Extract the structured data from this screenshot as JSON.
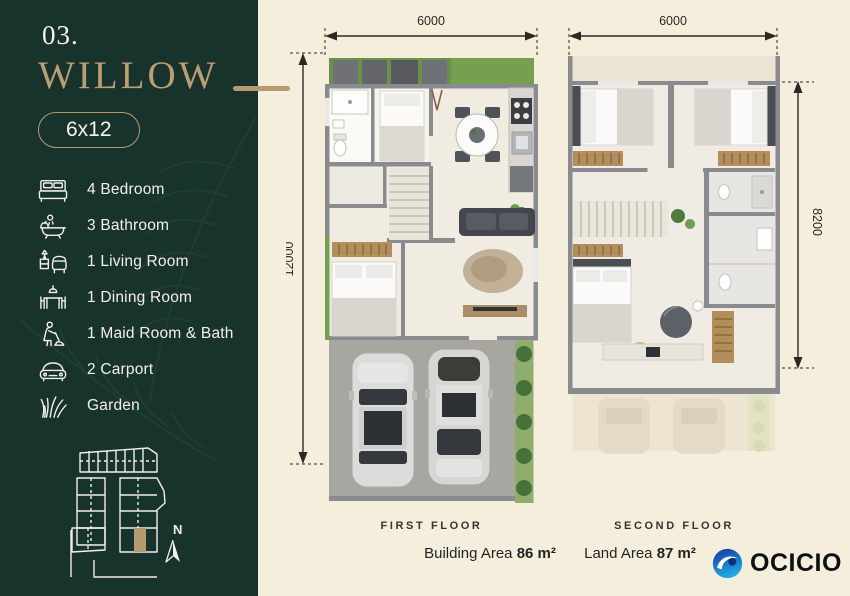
{
  "palette": {
    "sidebar_bg": "#18332b",
    "page_bg": "#f5eedd",
    "gold": "#b89b6d",
    "ink": "#2c2824"
  },
  "sidebar": {
    "number": "03.",
    "title": "WILLOW",
    "size_badge": "6x12",
    "amenities": [
      {
        "icon": "bed-icon",
        "label": "4 Bedroom"
      },
      {
        "icon": "bathtub-icon",
        "label": "3 Bathroom"
      },
      {
        "icon": "armchair-icon",
        "label": "1 Living Room"
      },
      {
        "icon": "dining-table-icon",
        "label": "1 Dining Room"
      },
      {
        "icon": "maid-icon",
        "label": "1 Maid Room & Bath"
      },
      {
        "icon": "car-icon",
        "label": "2 Carport"
      },
      {
        "icon": "grass-icon",
        "label": "Garden"
      }
    ],
    "compass": "N"
  },
  "plans": {
    "first": {
      "caption": "FIRST FLOOR",
      "width": "6000",
      "height": "12000"
    },
    "second": {
      "caption": "SECOND FLOOR",
      "width": "6000",
      "height": "8200"
    }
  },
  "areas": {
    "building_label": "Building Area",
    "building_value": "86 m²",
    "land_label": "Land Area",
    "land_value": "87 m²"
  },
  "logo": {
    "text": "OCICIO"
  }
}
